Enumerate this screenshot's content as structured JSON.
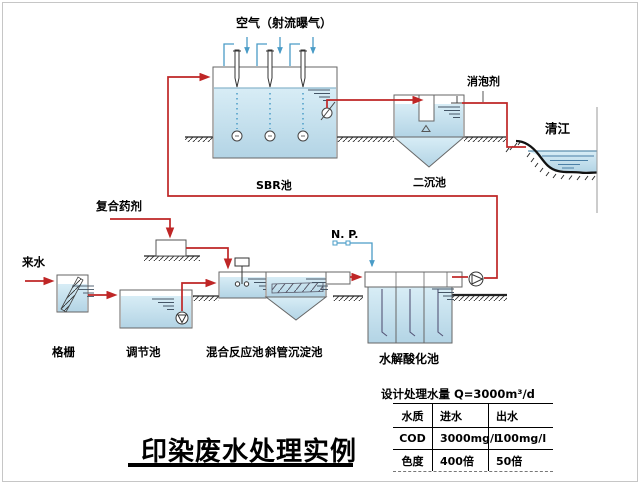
{
  "page": {
    "background": "#ffffff",
    "border_color": "#c6c6c6"
  },
  "labels": {
    "air": "空气（射流曝气）",
    "defoamer": "消泡剂",
    "river": "清江",
    "sbr": "SBR池",
    "secondary_clarifier": "二沉池",
    "chemical": "复合药剂",
    "influent": "来水",
    "np": "N. P.",
    "screen": "格栅",
    "regulating_tank": "调节池",
    "mixing_tank": "混合反应池",
    "inclined_settler": "斜管沉淀池",
    "hydrolysis_tank": "水解酸化池"
  },
  "table": {
    "title": "设计处理水量 Q=3000m³/d",
    "headers": [
      "水质",
      "进水",
      "出水"
    ],
    "rows": [
      [
        "COD",
        "3000mg/l",
        "100mg/l"
      ],
      [
        "色度",
        "400倍",
        "50倍"
      ]
    ]
  },
  "title": "印染废水处理实例",
  "colors": {
    "flow_line": "#bf2626",
    "air_pipe": "#4a9cc7",
    "water": "#bdd9e9",
    "outline": "#666666"
  }
}
